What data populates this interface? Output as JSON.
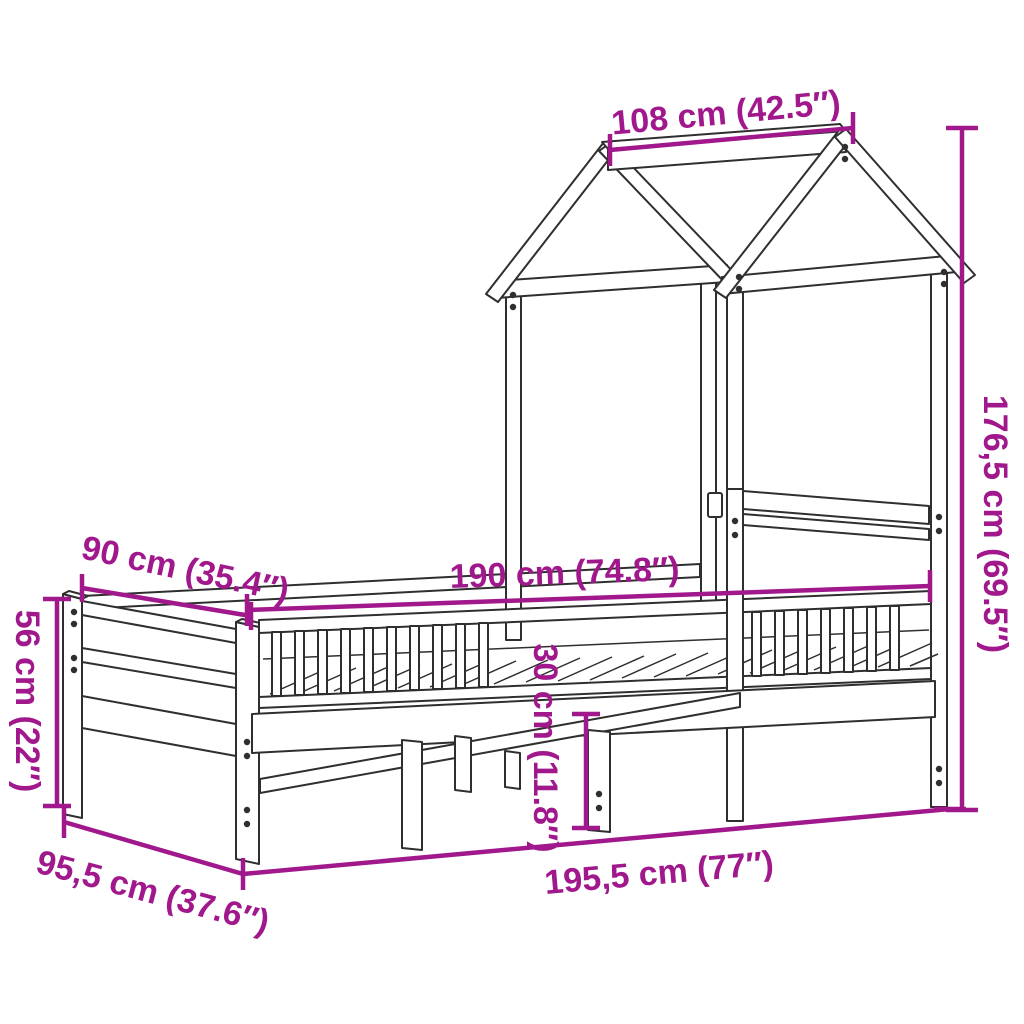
{
  "diagram": {
    "subject": "house-frame-bed-with-roof",
    "colors": {
      "dimension_accent": "#A0188C",
      "drawing_line": "#2F2F2F",
      "background": "#FFFFFF"
    },
    "dims": {
      "roof_depth": {
        "label": "108 cm (42.5″)",
        "value_cm": "108",
        "value_in": "42.5"
      },
      "total_height": {
        "label": "176,5 cm (69.5″)",
        "value_cm": "176,5",
        "value_in": "69.5"
      },
      "bed_width": {
        "label": "90 cm (35.4″)",
        "value_cm": "90",
        "value_in": "35.4"
      },
      "bed_length": {
        "label": "190 cm (74.8″)",
        "value_cm": "190",
        "value_in": "74.8"
      },
      "footboard_height": {
        "label": "56 cm (22″)",
        "value_cm": "56",
        "value_in": "22"
      },
      "clearance_height": {
        "label": "30 cm (11.8″)",
        "value_cm": "30",
        "value_in": "11.8"
      },
      "total_width": {
        "label": "95,5 cm (37.6″)",
        "value_cm": "95,5",
        "value_in": "37.6"
      },
      "total_length": {
        "label": "195,5 cm (77″)",
        "value_cm": "195,5",
        "value_in": "77"
      }
    }
  }
}
